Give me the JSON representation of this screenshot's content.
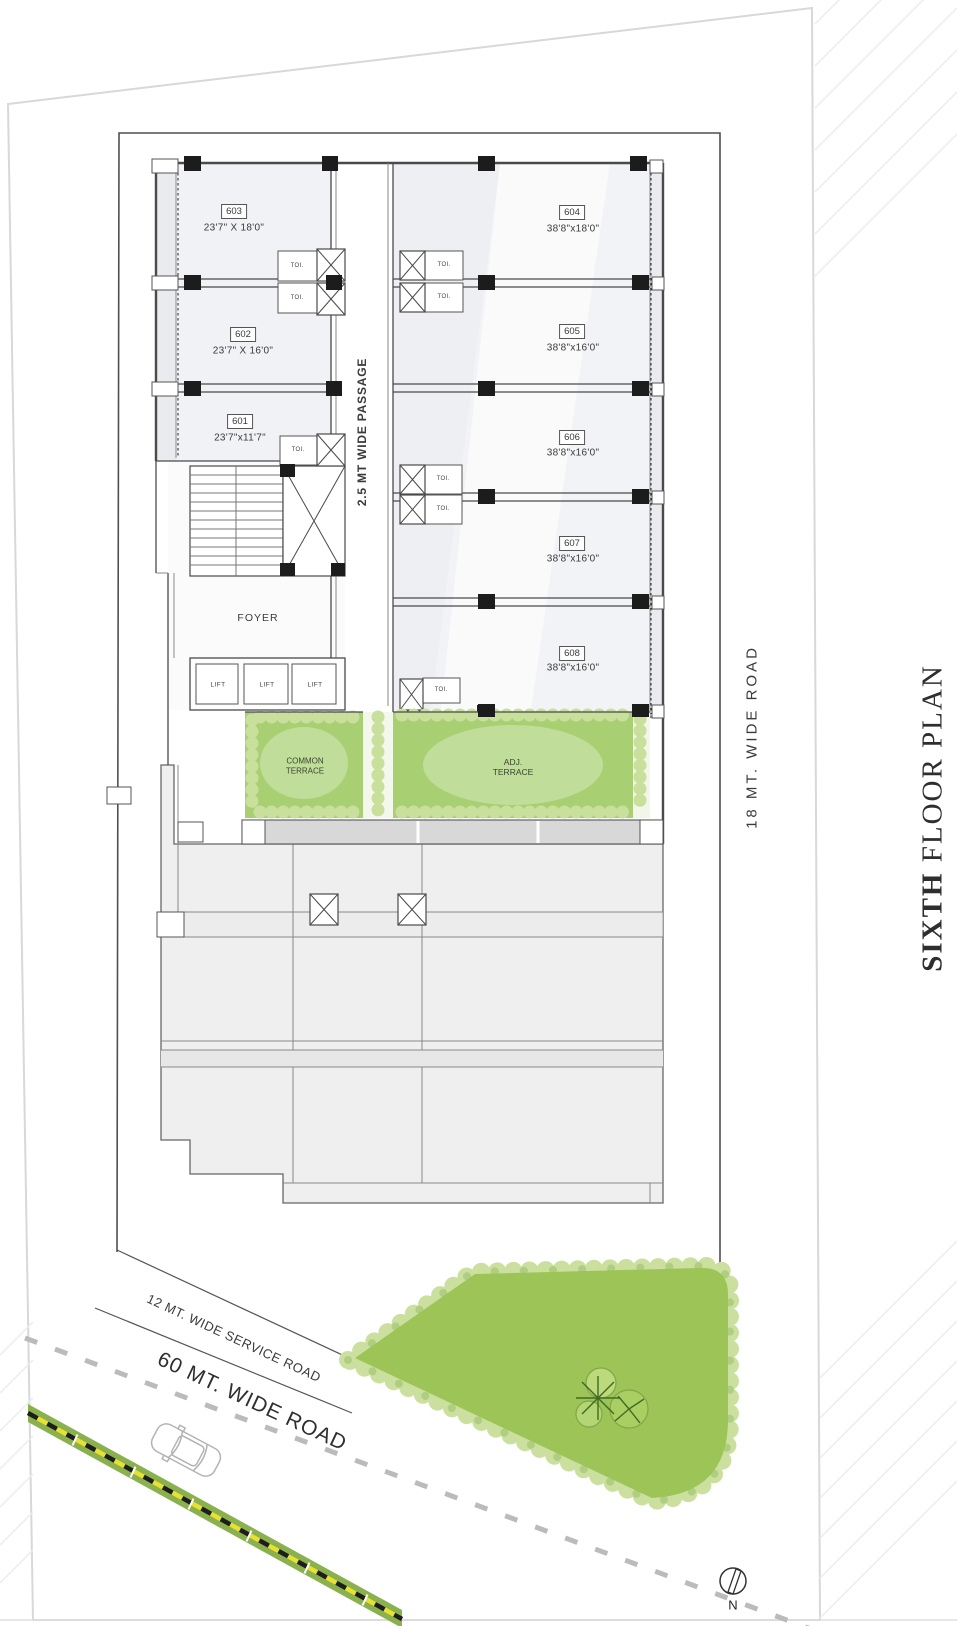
{
  "title": {
    "bold": "SIXTH",
    "regular": "FLOOR PLAN"
  },
  "roads": {
    "right_side": "18 MT. WIDE ROAD",
    "service": "12 MT. WIDE SERVICE ROAD",
    "main": "60 MT. WIDE ROAD",
    "passage": "2.5 MT WIDE PASSAGE"
  },
  "rooms": [
    {
      "number": "603",
      "dims": "23'7\" X 18'0\""
    },
    {
      "number": "602",
      "dims": "23'7\" X 16'0\""
    },
    {
      "number": "601",
      "dims": "23'7\"x11'7\""
    },
    {
      "number": "604",
      "dims": "38'8\"x18'0\""
    },
    {
      "number": "605",
      "dims": "38'8\"x16'0\""
    },
    {
      "number": "606",
      "dims": "38'8\"x16'0\""
    },
    {
      "number": "607",
      "dims": "38'8\"x16'0\""
    },
    {
      "number": "608",
      "dims": "38'8\"x16'0\""
    }
  ],
  "labels": {
    "foyer": "FOYER",
    "lift": "LIFT",
    "toilet": "TOI.",
    "common_terrace": "COMMON TERRACE",
    "adj_terrace": "ADJ. TERRACE",
    "north": "N"
  },
  "colors": {
    "terrace_green": "#a8d073",
    "garden_green": "#9dc457",
    "median_green": "#8ab14d",
    "wall_gray": "#4a4a4a",
    "column_black": "#1c1c1c",
    "text": "#3a3a3a"
  }
}
